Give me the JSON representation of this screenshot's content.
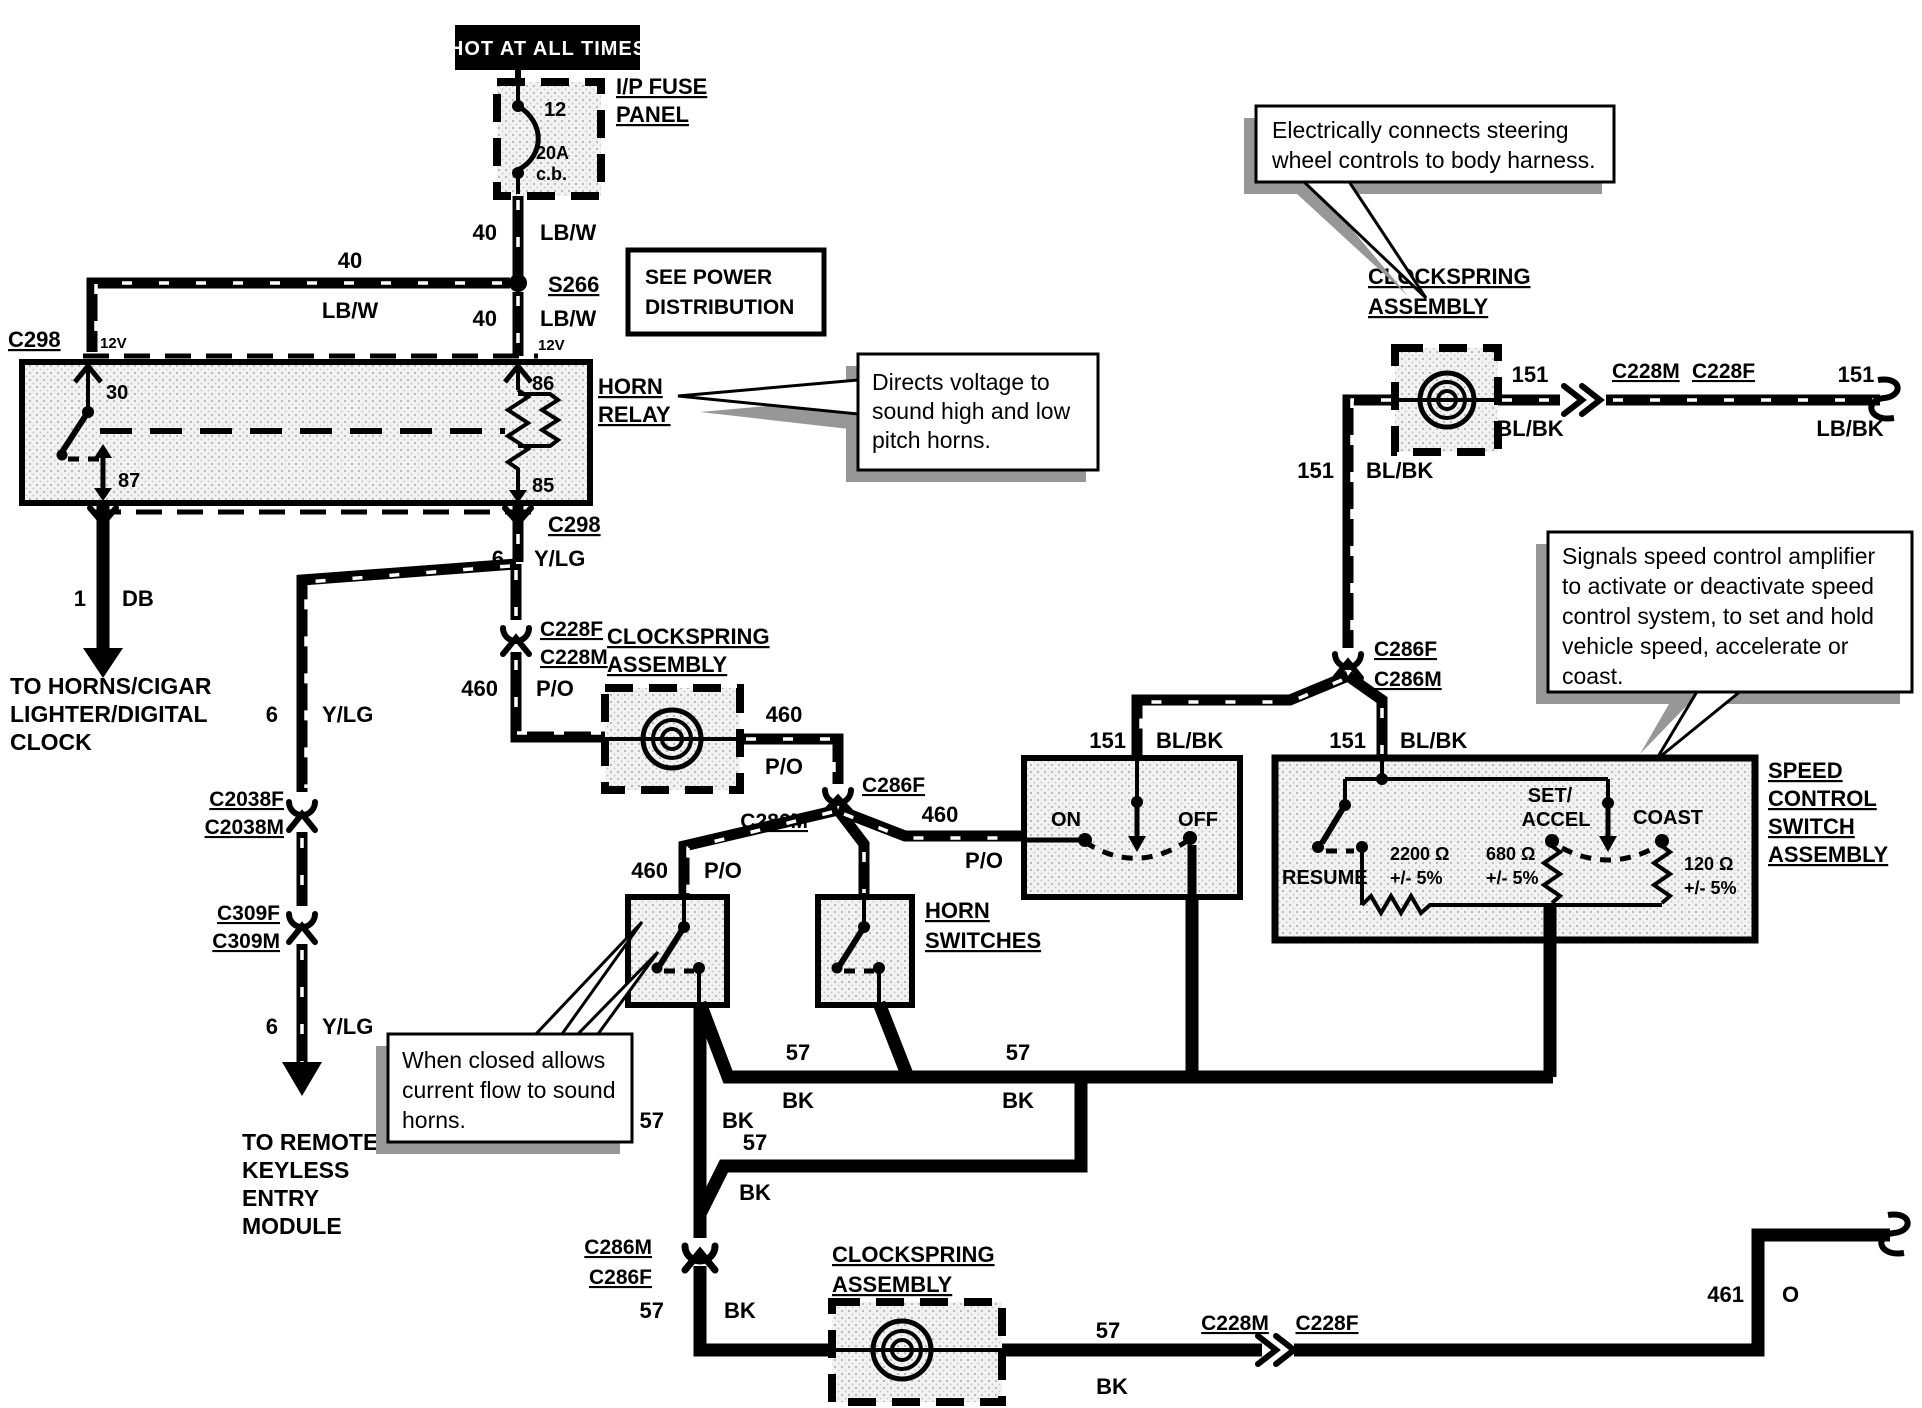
{
  "banner": {
    "hot": "HOT AT ALL TIMES"
  },
  "fuse_panel": {
    "name_1": "I/P FUSE",
    "name_2": "PANEL",
    "pin": "12",
    "rating_1": "20A",
    "rating_2": "c.b."
  },
  "splice": "S266",
  "see_power": {
    "line1": "SEE POWER",
    "line2": "DISTRIBUTION"
  },
  "horn_relay": {
    "name_1": "HORN",
    "name_2": "RELAY",
    "pin_30": "30",
    "pin_87": "87",
    "pin_86": "86",
    "pin_85": "85"
  },
  "connectors": {
    "c298": "C298",
    "c228f": "C228F",
    "c228m": "C228M",
    "c2038f": "C2038F",
    "c2038m": "C2038M",
    "c309f": "C309F",
    "c309m": "C309M",
    "c286f": "C286F",
    "c286m": "C286M"
  },
  "wires": {
    "n40": "40",
    "lb_w": "LB/W",
    "v12": "12V",
    "n1": "1",
    "db": "DB",
    "n6": "6",
    "y_lg": "Y/LG",
    "n460": "460",
    "p_o": "P/O",
    "n151": "151",
    "bl_bk": "BL/BK",
    "lb_bk": "LB/BK",
    "n57": "57",
    "bk": "BK",
    "n461": "461",
    "o": "O"
  },
  "clockspring": {
    "line1": "CLOCKSPRING",
    "line2": "ASSEMBLY"
  },
  "horn_switches": {
    "line1": "HORN",
    "line2": "SWITCHES"
  },
  "on_off_switch": {
    "on": "ON",
    "off": "OFF"
  },
  "speed_switch": {
    "name_1": "SPEED",
    "name_2": "CONTROL",
    "name_3": "SWITCH",
    "name_4": "ASSEMBLY",
    "resume": "RESUME",
    "set_1": "SET/",
    "set_2": "ACCEL",
    "coast": "COAST",
    "r_resume": "2200 Ω",
    "r_set": "680 Ω",
    "r_coast": "120 Ω",
    "tol": "+/- 5%"
  },
  "callouts": {
    "relay": {
      "l1": "Directs voltage to",
      "l2": "sound high and low",
      "l3": "pitch horns."
    },
    "clockspring": {
      "l1": "Electrically connects steering",
      "l2": "wheel controls to body harness."
    },
    "speed": {
      "l1": "Signals speed control amplifier",
      "l2": "to activate or deactivate speed",
      "l3": "control system, to set and hold",
      "l4": "vehicle speed, accelerate or",
      "l5": "coast."
    },
    "horn": {
      "l1": "When closed allows",
      "l2": "current flow to sound",
      "l3": "horns."
    }
  },
  "destinations": {
    "horns": {
      "l1": "TO HORNS/CIGAR",
      "l2": "LIGHTER/DIGITAL",
      "l3": "CLOCK"
    },
    "keyless": {
      "l1": "TO REMOTE",
      "l2": "KEYLESS",
      "l3": "ENTRY",
      "l4": "MODULE"
    }
  }
}
